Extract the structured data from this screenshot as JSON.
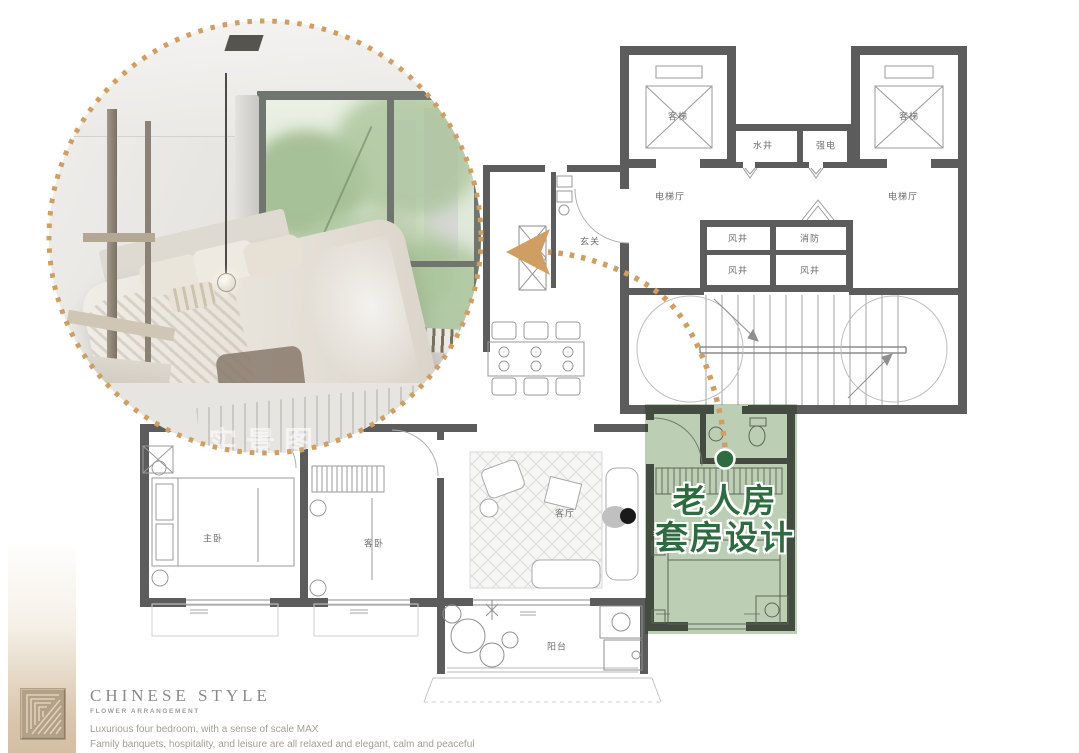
{
  "callout": {
    "line1": "老人房",
    "line2": "套房设计"
  },
  "photo": {
    "watermark": "实景图"
  },
  "floor_plan": {
    "labels": {
      "elevator_left": "客梯",
      "elevator_right": "客梯",
      "water_shaft": "水井",
      "electrical_room": "强电",
      "elevator_hall_left": "电梯厅",
      "elevator_hall_right": "电梯厅",
      "air_shaft_1": "风井",
      "fire_room": "消防",
      "air_shaft_2": "风井",
      "air_shaft_3": "风井",
      "foyer": "玄关",
      "living_room": "客厅",
      "balcony": "阳台",
      "master_bedroom": "主卧",
      "guest_bedroom": "客卧"
    }
  },
  "branding": {
    "title": "CHINESE STYLE",
    "subtitle": "FLOWER ARRANGEMENT",
    "line1": "Luxurious four bedroom, with a sense of scale MAX",
    "line2": "Family banquets, hospitality, and leisure are all relaxed and elegant, calm and peaceful"
  },
  "colors": {
    "accent_tan": "#cf9e63",
    "green_dark": "#2e6b41",
    "green_highlight": "#bccfb4",
    "wall_gray": "#5c5c5c"
  }
}
